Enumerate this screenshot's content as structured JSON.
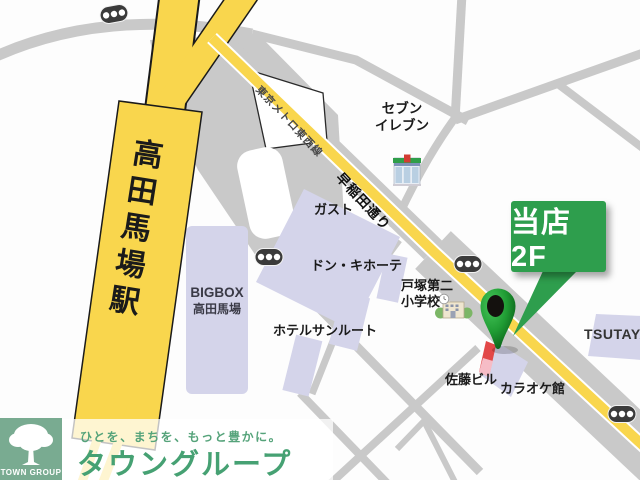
{
  "map": {
    "station": {
      "name": "高田馬場駅"
    },
    "roads": {
      "metro_line": "東京メトロ東西線",
      "waseda_street": "早稲田通り"
    },
    "places": {
      "seven_eleven_line1": "セブン",
      "seven_eleven_line2": "イレブン",
      "gusto": "ガスト",
      "don_quijote": "ドン・キホーテ",
      "bigbox_line1": "BIGBOX",
      "bigbox_line2": "高田馬場",
      "hotel_sunroute": "ホテルサンルート",
      "school_line1": "戸塚第二",
      "school_line2": "小学校",
      "sato_building": "佐藤ビル",
      "karaoke_kan": "カラオケ館",
      "tsutaya": "TSUTAYA"
    },
    "callout": {
      "label": "当店2F",
      "color": "#2e9e4d"
    },
    "icons": [
      "map-pin-icon",
      "traffic-light-icon",
      "convenience-store-icon",
      "school-icon",
      "red-building-marker"
    ]
  },
  "banner": {
    "tagline": "ひとを、まちを、もっと豊かに。",
    "company": "タウングループ",
    "logo_text": "TOWN GROUP"
  },
  "colors": {
    "road_gray": "#c9c9c9",
    "road_yellow": "#f9d64d",
    "building_lavender": "#d4d4ea",
    "callout_green": "#2e9e4d",
    "pin_green": "#1f9b33",
    "logo_green": "#79ab91",
    "text_green": "#46a173"
  }
}
